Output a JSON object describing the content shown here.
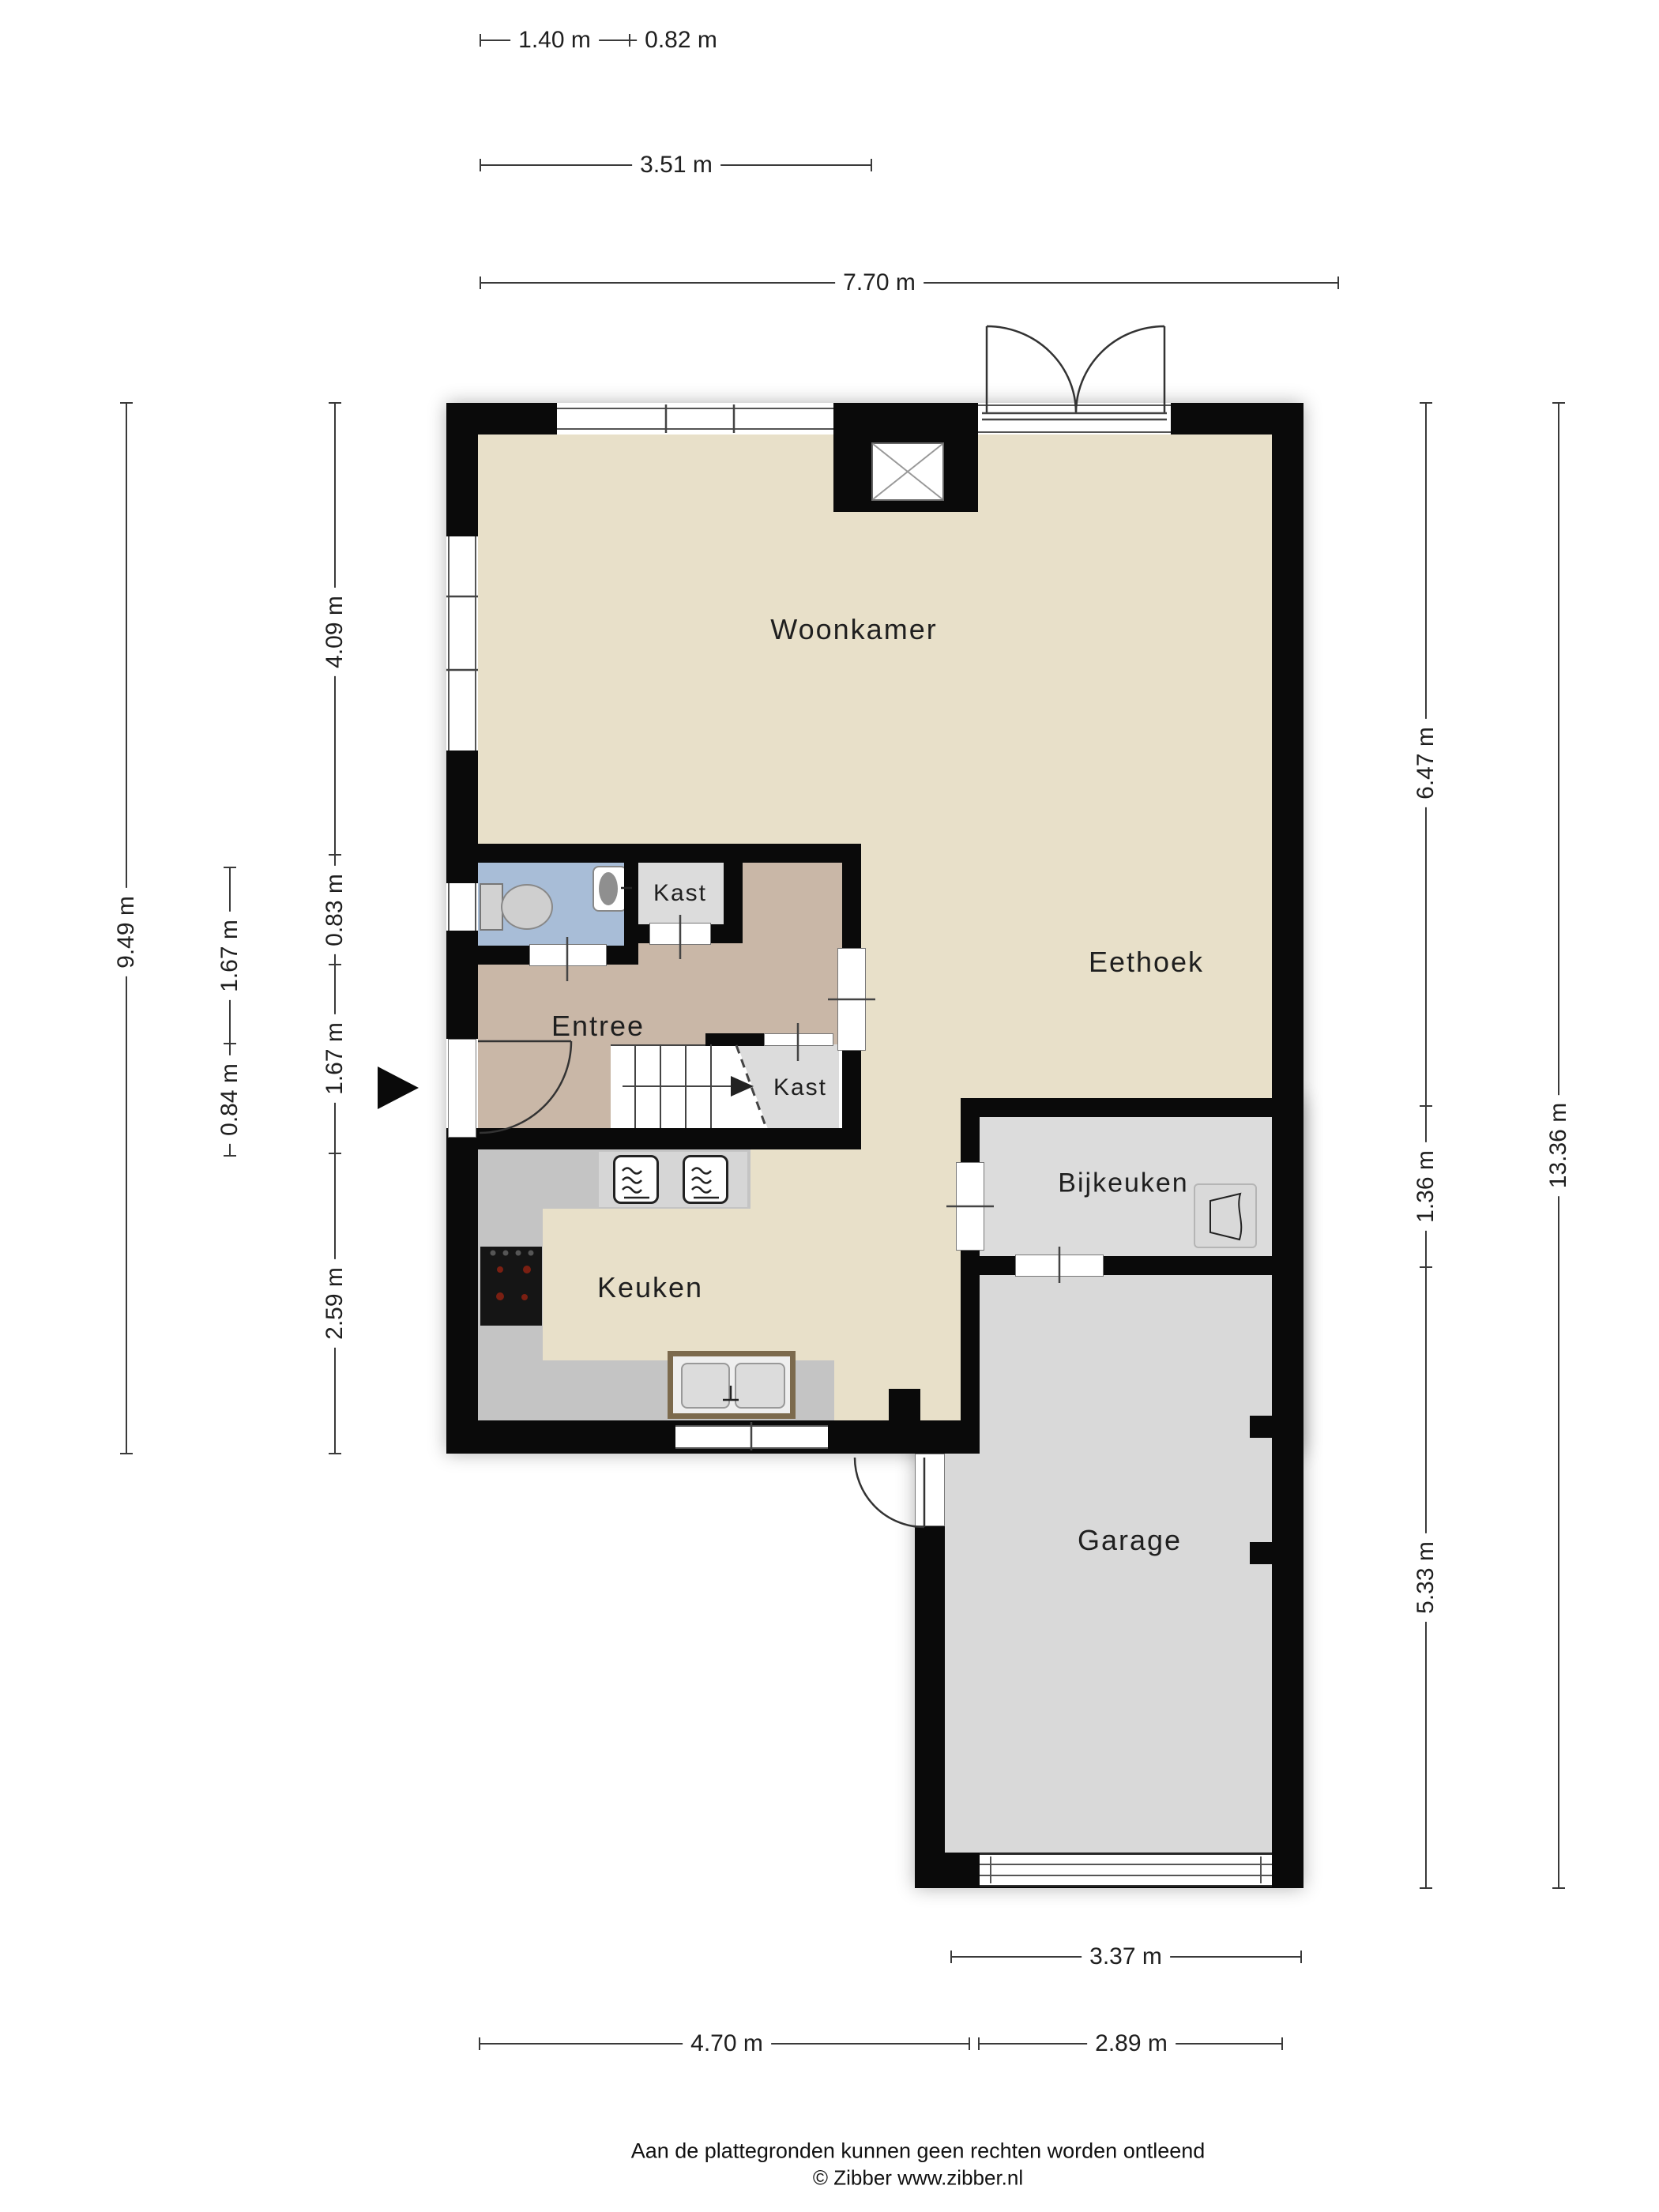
{
  "rooms": {
    "woonkamer": {
      "label": "Woonkamer"
    },
    "eethoek": {
      "label": "Eethoek"
    },
    "entree": {
      "label": "Entree"
    },
    "kast_boven": {
      "label": "Kast"
    },
    "kast_trap": {
      "label": "Kast"
    },
    "keuken": {
      "label": "Keuken"
    },
    "bijkeuken": {
      "label": "Bijkeuken"
    },
    "garage": {
      "label": "Garage"
    }
  },
  "dimensions": {
    "top": [
      {
        "label": "1.40 m"
      },
      {
        "label": "0.82 m"
      },
      {
        "label": "3.51 m"
      },
      {
        "label": "7.70 m"
      }
    ],
    "left": [
      {
        "label": "9.49 m"
      },
      {
        "label": "1.67 m"
      },
      {
        "label": "0.84 m"
      },
      {
        "label": "4.09 m"
      },
      {
        "label": "0.83 m"
      },
      {
        "label": "1.67 m"
      },
      {
        "label": "2.59 m"
      }
    ],
    "right": [
      {
        "label": "6.47 m"
      },
      {
        "label": "1.36 m"
      },
      {
        "label": "5.33 m"
      },
      {
        "label": "13.36 m"
      }
    ],
    "bottom": [
      {
        "label": "3.37 m"
      },
      {
        "label": "4.70 m"
      },
      {
        "label": "2.89 m"
      }
    ]
  },
  "footer": {
    "disclaimer": "Aan de plattegronden kunnen geen rechten worden ontleend",
    "copyright": "© Zibber www.zibber.nl"
  },
  "icons": {
    "entrance_arrow": "solid right-pointing triangle",
    "stairs_arrow": "up-direction arrow",
    "toilet": "toilet plan symbol",
    "washbasin": "corner washbasin",
    "cooktop": "4-burner ceramic hob",
    "ovens": "two built-in ovens",
    "kitchen_sink": "double-basin sink",
    "boiler": "heater / ventilation unit",
    "chimney": "crossed-box chimney"
  },
  "colors": {
    "wall": "#0a0a0a",
    "beige": "#e8e0c9",
    "entree": "#c9b7a7",
    "toilet_blue": "#a8bdd7",
    "storage": "#dcdcdc",
    "garage": "#d9d9d9",
    "counter": "#c4c4c4",
    "burner": "#d8372a",
    "sink_border": "#7c6a4d",
    "line": "#3a3a3a"
  }
}
